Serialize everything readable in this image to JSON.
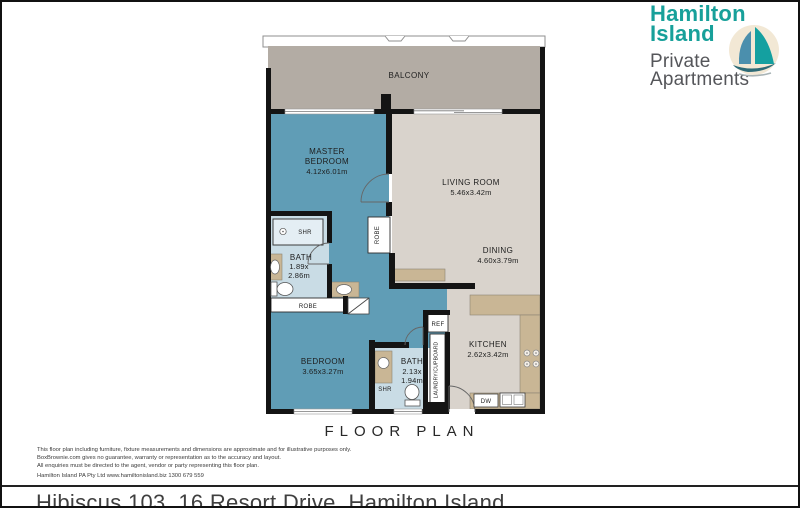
{
  "brand": {
    "name_line1": "Hamilton",
    "name_line2": "Island",
    "sub_line1": "Private",
    "sub_line2": "Apartments",
    "teal": "#17a09a",
    "gray": "#55565a"
  },
  "plan": {
    "title": "FLOOR PLAN",
    "balcony": {
      "label": "BALCONY"
    },
    "master_bedroom": {
      "label_line1": "MASTER",
      "label_line2": "BEDROOM",
      "dims": "4.12x6.01m"
    },
    "living_room": {
      "label": "LIVING ROOM",
      "dims": "5.46x3.42m"
    },
    "dining": {
      "label": "DINING",
      "dims": "4.60x3.79m"
    },
    "kitchen": {
      "label": "KITCHEN",
      "dims": "2.62x3.42m"
    },
    "bedroom": {
      "label": "BEDROOM",
      "dims": "3.65x3.27m"
    },
    "bath_ensuite": {
      "label": "BATH",
      "dims_line1": "1.89x",
      "dims_line2": "2.86m",
      "shower": "SHR"
    },
    "bath_main": {
      "label": "BATH",
      "dims_line1": "2.13x",
      "dims_line2": "1.94m",
      "shower": "SHR"
    },
    "robe_master": "ROBE",
    "robe_hall": "ROBE",
    "fridge": "REF",
    "laundry": "LAUNDRY/CUPBOARD",
    "dishwasher": "DW"
  },
  "disclaimer": {
    "line1": "This floor plan including furniture, fixture measurements and dimensions are approximate and for illustrative purposes only.",
    "line2": "BoxBrownie.com gives no guarantee, warranty or representation as to the accuracy and layout.",
    "line3": "All enquiries must be directed to the agent, vendor or party representing this floor plan.",
    "line4": "Hamilton Island PA Pty Ltd www.hamiltonisland.biz 1300 679 559"
  },
  "footer": {
    "address": "Hibiscus 103, 16 Resort Drive, Hamilton Island"
  },
  "colors": {
    "room_blue": "#609db6",
    "bath_blue": "#c9dce5",
    "shower_blue": "#e4eef4",
    "floor_beige": "#d9d3cc",
    "balcony_taupe": "#b3aca4",
    "bench_tan": "#c9b695",
    "wall_black": "#141414"
  }
}
